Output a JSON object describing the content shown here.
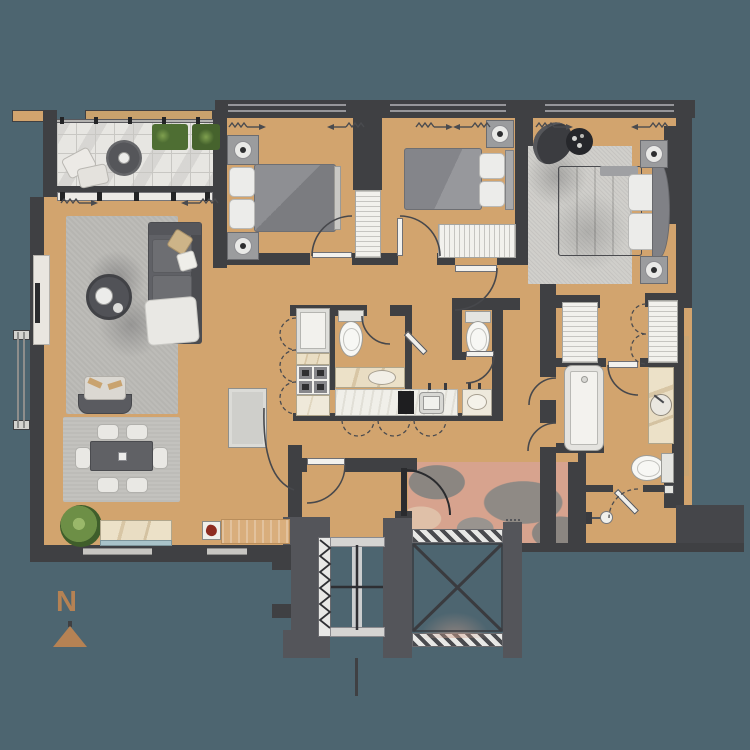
{
  "title": "apartment-floor-plan",
  "compass": {
    "label": "N"
  },
  "palette": {
    "background": "#4d6570",
    "wall": "#3f4043",
    "wall_light": "#54555a",
    "floor": "#d2a46e",
    "balcony_tile": "#e7e6e2",
    "rug": "#bdbcb8",
    "fixture_white": "#f2f1ed",
    "marble_counter": "#e8dcc2",
    "foyer_marble": "#d7a38e",
    "north_arrow": "#b58254",
    "plant_green": "#6d8f46",
    "wood": "#d9ae7c",
    "decor_red": "#8e2b20"
  },
  "rooms": [
    {
      "name": "balcony"
    },
    {
      "name": "living-room"
    },
    {
      "name": "dining-area"
    },
    {
      "name": "kitchen"
    },
    {
      "name": "bathroom"
    },
    {
      "name": "powder-room"
    },
    {
      "name": "hallway"
    },
    {
      "name": "bedroom-2"
    },
    {
      "name": "bedroom-3"
    },
    {
      "name": "master-bedroom"
    },
    {
      "name": "walk-in-closet"
    },
    {
      "name": "master-bathroom"
    },
    {
      "name": "shower-wc"
    },
    {
      "name": "entry-foyer"
    },
    {
      "name": "elevator-core"
    }
  ],
  "furniture": [
    "lounge-cushions",
    "planters",
    "outdoor-rug",
    "sofa",
    "coffee-table",
    "tv-console",
    "armchair",
    "dining-table",
    "dining-chairs-6",
    "potted-plant",
    "marble-console",
    "wood-console",
    "tall-cabinet",
    "fridge",
    "stove-4-burners",
    "kitchen-counter",
    "kitchen-sink",
    "cooktop",
    "toilet-x3",
    "vanity-basin-x3",
    "bathtub",
    "shower-mixer",
    "double-bed-x3",
    "nightstands",
    "wardrobes",
    "walk-in-wardrobes",
    "lounge-chair",
    "side-table"
  ],
  "core": {
    "elevators": 2,
    "shaft_marking": "X-cross"
  }
}
